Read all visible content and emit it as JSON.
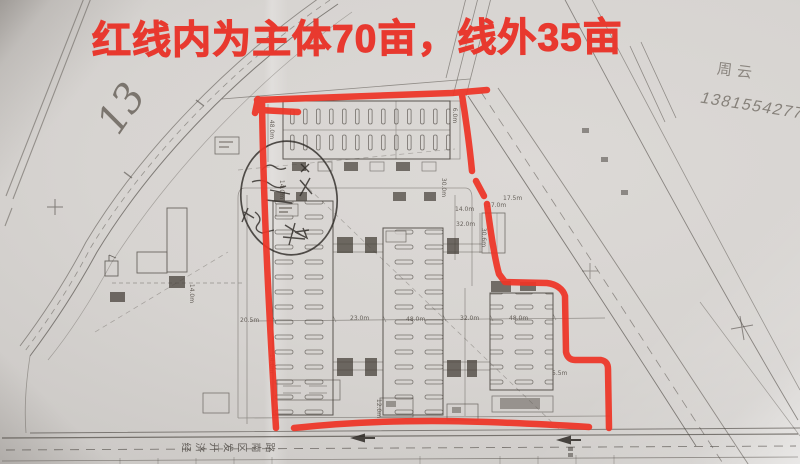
{
  "photo": {
    "red_annotation_title": "红线内为主体70亩，线外35亩",
    "corner_page_number": "13",
    "handwriting": {
      "name": "周云",
      "phone": "13815542777"
    },
    "colors": {
      "marker_red": "#ee3527",
      "paper": "#d6d3d0",
      "ink": "#45403a",
      "pencil": "#6b655d"
    },
    "plan": {
      "south_road_name": "经济开发区南路",
      "dimension_labels": [
        {
          "t": "48.0m",
          "x": 262,
          "y": 126,
          "r": 90
        },
        {
          "t": "14.0m",
          "x": 272,
          "y": 186,
          "r": 90
        },
        {
          "t": "30.0m",
          "x": 434,
          "y": 184,
          "r": 90
        },
        {
          "t": "6.0m",
          "x": 447,
          "y": 112,
          "r": 90
        },
        {
          "t": "14.0m",
          "x": 455,
          "y": 206,
          "r": 0
        },
        {
          "t": "32.0m",
          "x": 456,
          "y": 221,
          "r": 0
        },
        {
          "t": "17.0m",
          "x": 487,
          "y": 202,
          "r": 0
        },
        {
          "t": "17.5m",
          "x": 503,
          "y": 195,
          "r": 0
        },
        {
          "t": "30.6m",
          "x": 474,
          "y": 234,
          "r": 90
        },
        {
          "t": "14.0m",
          "x": 182,
          "y": 290,
          "r": 90
        },
        {
          "t": "20.5m",
          "x": 240,
          "y": 317,
          "r": 0
        },
        {
          "t": "23.0m",
          "x": 350,
          "y": 315,
          "r": 0
        },
        {
          "t": "48.0m",
          "x": 406,
          "y": 316,
          "r": 0
        },
        {
          "t": "32.0m",
          "x": 460,
          "y": 315,
          "r": 0
        },
        {
          "t": "48.0m",
          "x": 509,
          "y": 315,
          "r": 0
        },
        {
          "t": "5.5m",
          "x": 552,
          "y": 370,
          "r": 0
        },
        {
          "t": "12.0m",
          "x": 369,
          "y": 405,
          "r": 90
        },
        {
          "t": "14.0m",
          "x": 262,
          "y": 360,
          "r": 90
        }
      ]
    }
  }
}
